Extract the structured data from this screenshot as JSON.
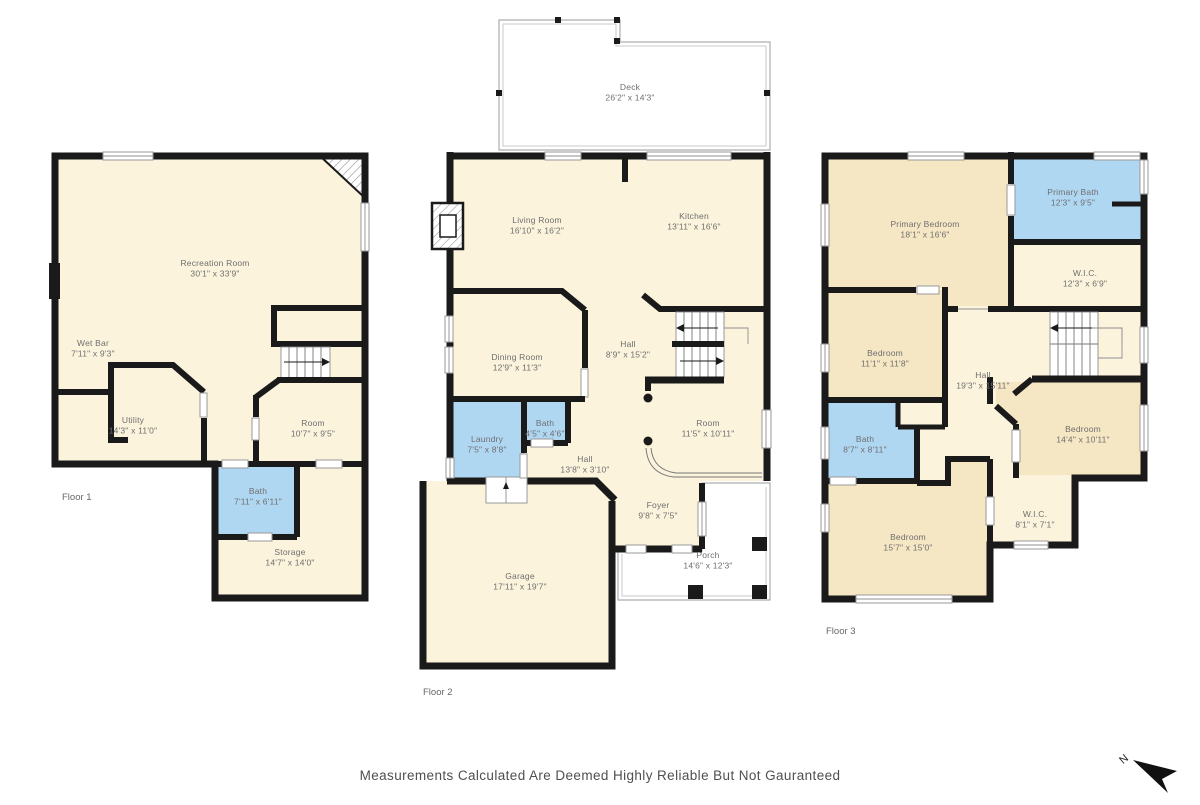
{
  "disclaimer": "Measurements Calculated Are Deemed Highly Reliable But Not Gauranteed",
  "compass": {
    "north_label": "N"
  },
  "colors": {
    "wall": "#1a1a1a",
    "room": "#FBF3DC",
    "room_accent": "#F6E7C4",
    "bath": "#B0D7F2",
    "outdoor": "#E9EAEB",
    "porch": "#E7E8EA",
    "label_text": "#6F6F6F"
  },
  "floors": [
    {
      "label": "Floor 1",
      "rooms": [
        {
          "name": "Recreation Room",
          "dims": "30'1\" x 33'9\""
        },
        {
          "name": "Wet Bar",
          "dims": "7'11\" x 9'3\""
        },
        {
          "name": "Utility",
          "dims": "14'3\" x 11'0\""
        },
        {
          "name": "Room",
          "dims": "10'7\" x 9'5\""
        },
        {
          "name": "Bath",
          "dims": "7'11\" x 6'11\""
        },
        {
          "name": "Storage",
          "dims": "14'7\" x 14'0\""
        }
      ]
    },
    {
      "label": "Floor 2",
      "rooms": [
        {
          "name": "Deck",
          "dims": "26'2\" x 14'3\""
        },
        {
          "name": "Living Room",
          "dims": "16'10\" x 16'2\""
        },
        {
          "name": "Kitchen",
          "dims": "13'11\" x 16'6\""
        },
        {
          "name": "Dining Room",
          "dims": "12'9\" x 11'3\""
        },
        {
          "name": "Hall",
          "dims": "8'9\" x 15'2\""
        },
        {
          "name": "Laundry",
          "dims": "7'5\" x 8'8\""
        },
        {
          "name": "Bath",
          "dims": "4'5\" x 4'6\""
        },
        {
          "name": "Hall",
          "dims": "13'8\" x 3'10\""
        },
        {
          "name": "Room",
          "dims": "11'5\" x 10'11\""
        },
        {
          "name": "Foyer",
          "dims": "9'8\" x 7'5\""
        },
        {
          "name": "Porch",
          "dims": "14'6\" x 12'3\""
        },
        {
          "name": "Garage",
          "dims": "17'11\" x 19'7\""
        }
      ]
    },
    {
      "label": "Floor 3",
      "rooms": [
        {
          "name": "Primary Bedroom",
          "dims": "18'1\" x 16'6\""
        },
        {
          "name": "Primary Bath",
          "dims": "12'3\" x 9'5\""
        },
        {
          "name": "W.I.C.",
          "dims": "12'3\" x 6'9\""
        },
        {
          "name": "Bedroom",
          "dims": "11'1\" x 11'8\""
        },
        {
          "name": "Hall",
          "dims": "19'3\" x 15'11\""
        },
        {
          "name": "Bath",
          "dims": "8'7\" x 8'11\""
        },
        {
          "name": "Bedroom",
          "dims": "14'4\" x 10'11\""
        },
        {
          "name": "W.I.C.",
          "dims": "8'1\" x 7'1\""
        },
        {
          "name": "Bedroom",
          "dims": "15'7\" x 15'0\""
        }
      ]
    }
  ]
}
